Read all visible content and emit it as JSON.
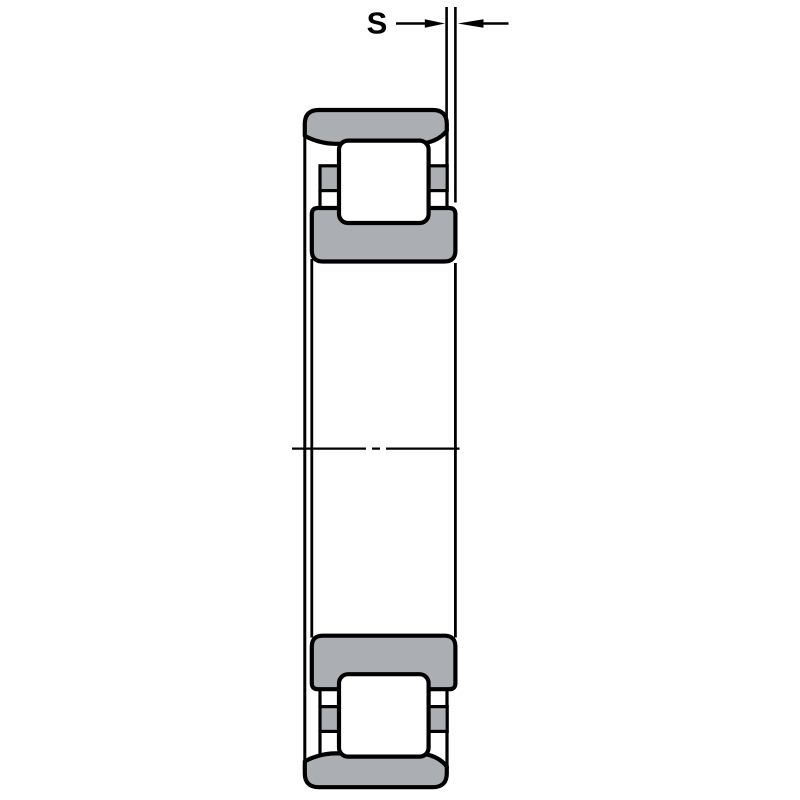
{
  "figure": {
    "type": "technical-section-drawing",
    "subject": "cylindrical-roller-bearing-cross-section",
    "dimension_label": "S"
  },
  "colors": {
    "background": "#ffffff",
    "section_gray": "#abaeb2",
    "roller_white": "#ffffff",
    "line_black": "#000000"
  },
  "parts": [
    "dimension-s",
    "outer-ring",
    "cylindrical-roller",
    "cage",
    "inner-ring-with-ribs",
    "bore",
    "axis-centerline"
  ]
}
